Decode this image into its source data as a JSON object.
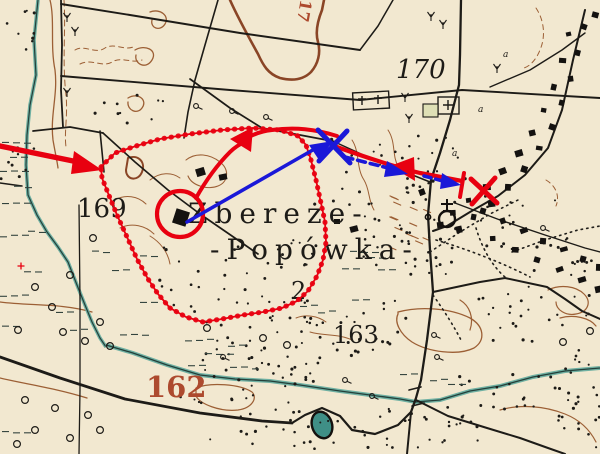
{
  "map": {
    "labels": {
      "hill_170": "170",
      "hill_169": "169",
      "hill_163": "163.",
      "contour_162": "162",
      "contour_17_partial": "17",
      "village_name_line1": "Zbereże-",
      "village_name_line2": "-Popówka-",
      "village_number": "2",
      "tiny_a_1": "a",
      "tiny_a_2": "a",
      "tiny_a_3": "a"
    },
    "colors": {
      "paper": "#f2e8d0",
      "black_ink": "#1d1b17",
      "contour_brown": "#9c5f35",
      "contour_label_red_brown": "#ad4a2e",
      "water_teal": "#5fa396",
      "annotation_red": "#e80010",
      "annotation_blue": "#1a18d8"
    }
  }
}
